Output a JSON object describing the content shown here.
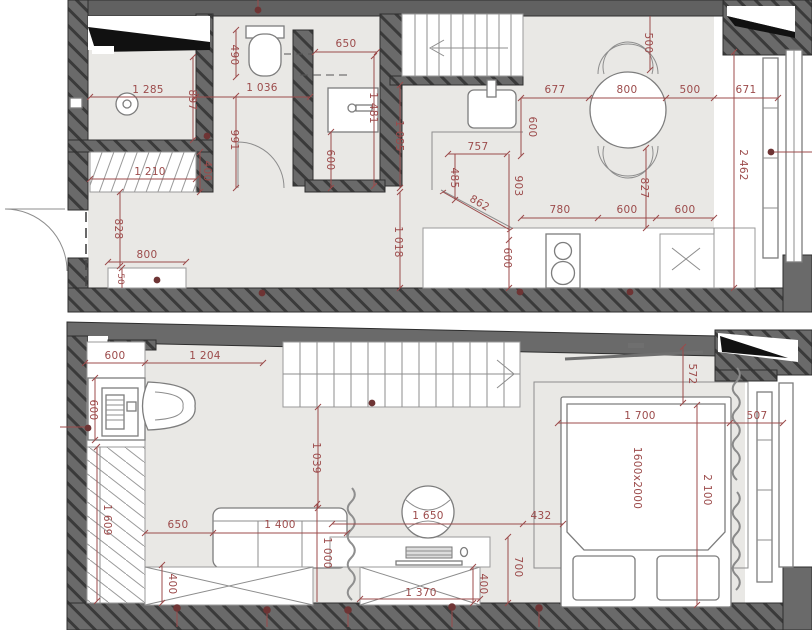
{
  "plan_type": "two-level apartment floor plan",
  "colors": {
    "dimension": "#9c4b4b",
    "marker": "#6e3434",
    "wall_fill": "#6a6a6a",
    "wall_hatch": "#3a3a3a",
    "floor": "#e9e8e5",
    "furniture_line": "#7d7d7d"
  },
  "upper": {
    "name": "upper-floor-plan",
    "dims": {
      "shower_width": "1 285",
      "shower_depth": "897",
      "wc_side": "490",
      "wc_width": "1 036",
      "wc_depth": "991",
      "bath_top": "650",
      "bath_side": "1 481",
      "bath_sink": "600",
      "hall_side": "1 085",
      "closet_width": "1 210",
      "closet_depth": "400",
      "hall_depth": "828",
      "bench_width": "800",
      "bench_depth": "50",
      "hall_length": "1 018",
      "island_width": "757",
      "island_depth": "485",
      "island_side": "903",
      "island_diag": "862",
      "dining_left": "677",
      "table_diam": "800",
      "dining_right": "500",
      "window_side": "671",
      "chair_zone": "500",
      "island_offset": "600",
      "table_offset": "827",
      "counter_a": "780",
      "counter_b": "600",
      "counter_c": "600",
      "counter_depth": "600",
      "room_depth": "2 462"
    }
  },
  "lower": {
    "name": "lower-floor-plan",
    "dims": {
      "desk_width": "600",
      "landing_width": "1 204",
      "desk_depth": "600",
      "passage": "1 039",
      "tv_offset": "572",
      "bed_zone": "1 700",
      "bed_side": "507",
      "bed_size": "1600x2000",
      "bed_length": "2 100",
      "wardrobe_length": "1 609",
      "sofa_offset": "650",
      "sofa_width": "1 400",
      "sofa_depth": "1 000",
      "bed_offset": "432",
      "chair_zone": "1 650",
      "desk_zone": "700",
      "storage_left": "400",
      "storage_right": "400",
      "storage_width": "1 370"
    }
  }
}
